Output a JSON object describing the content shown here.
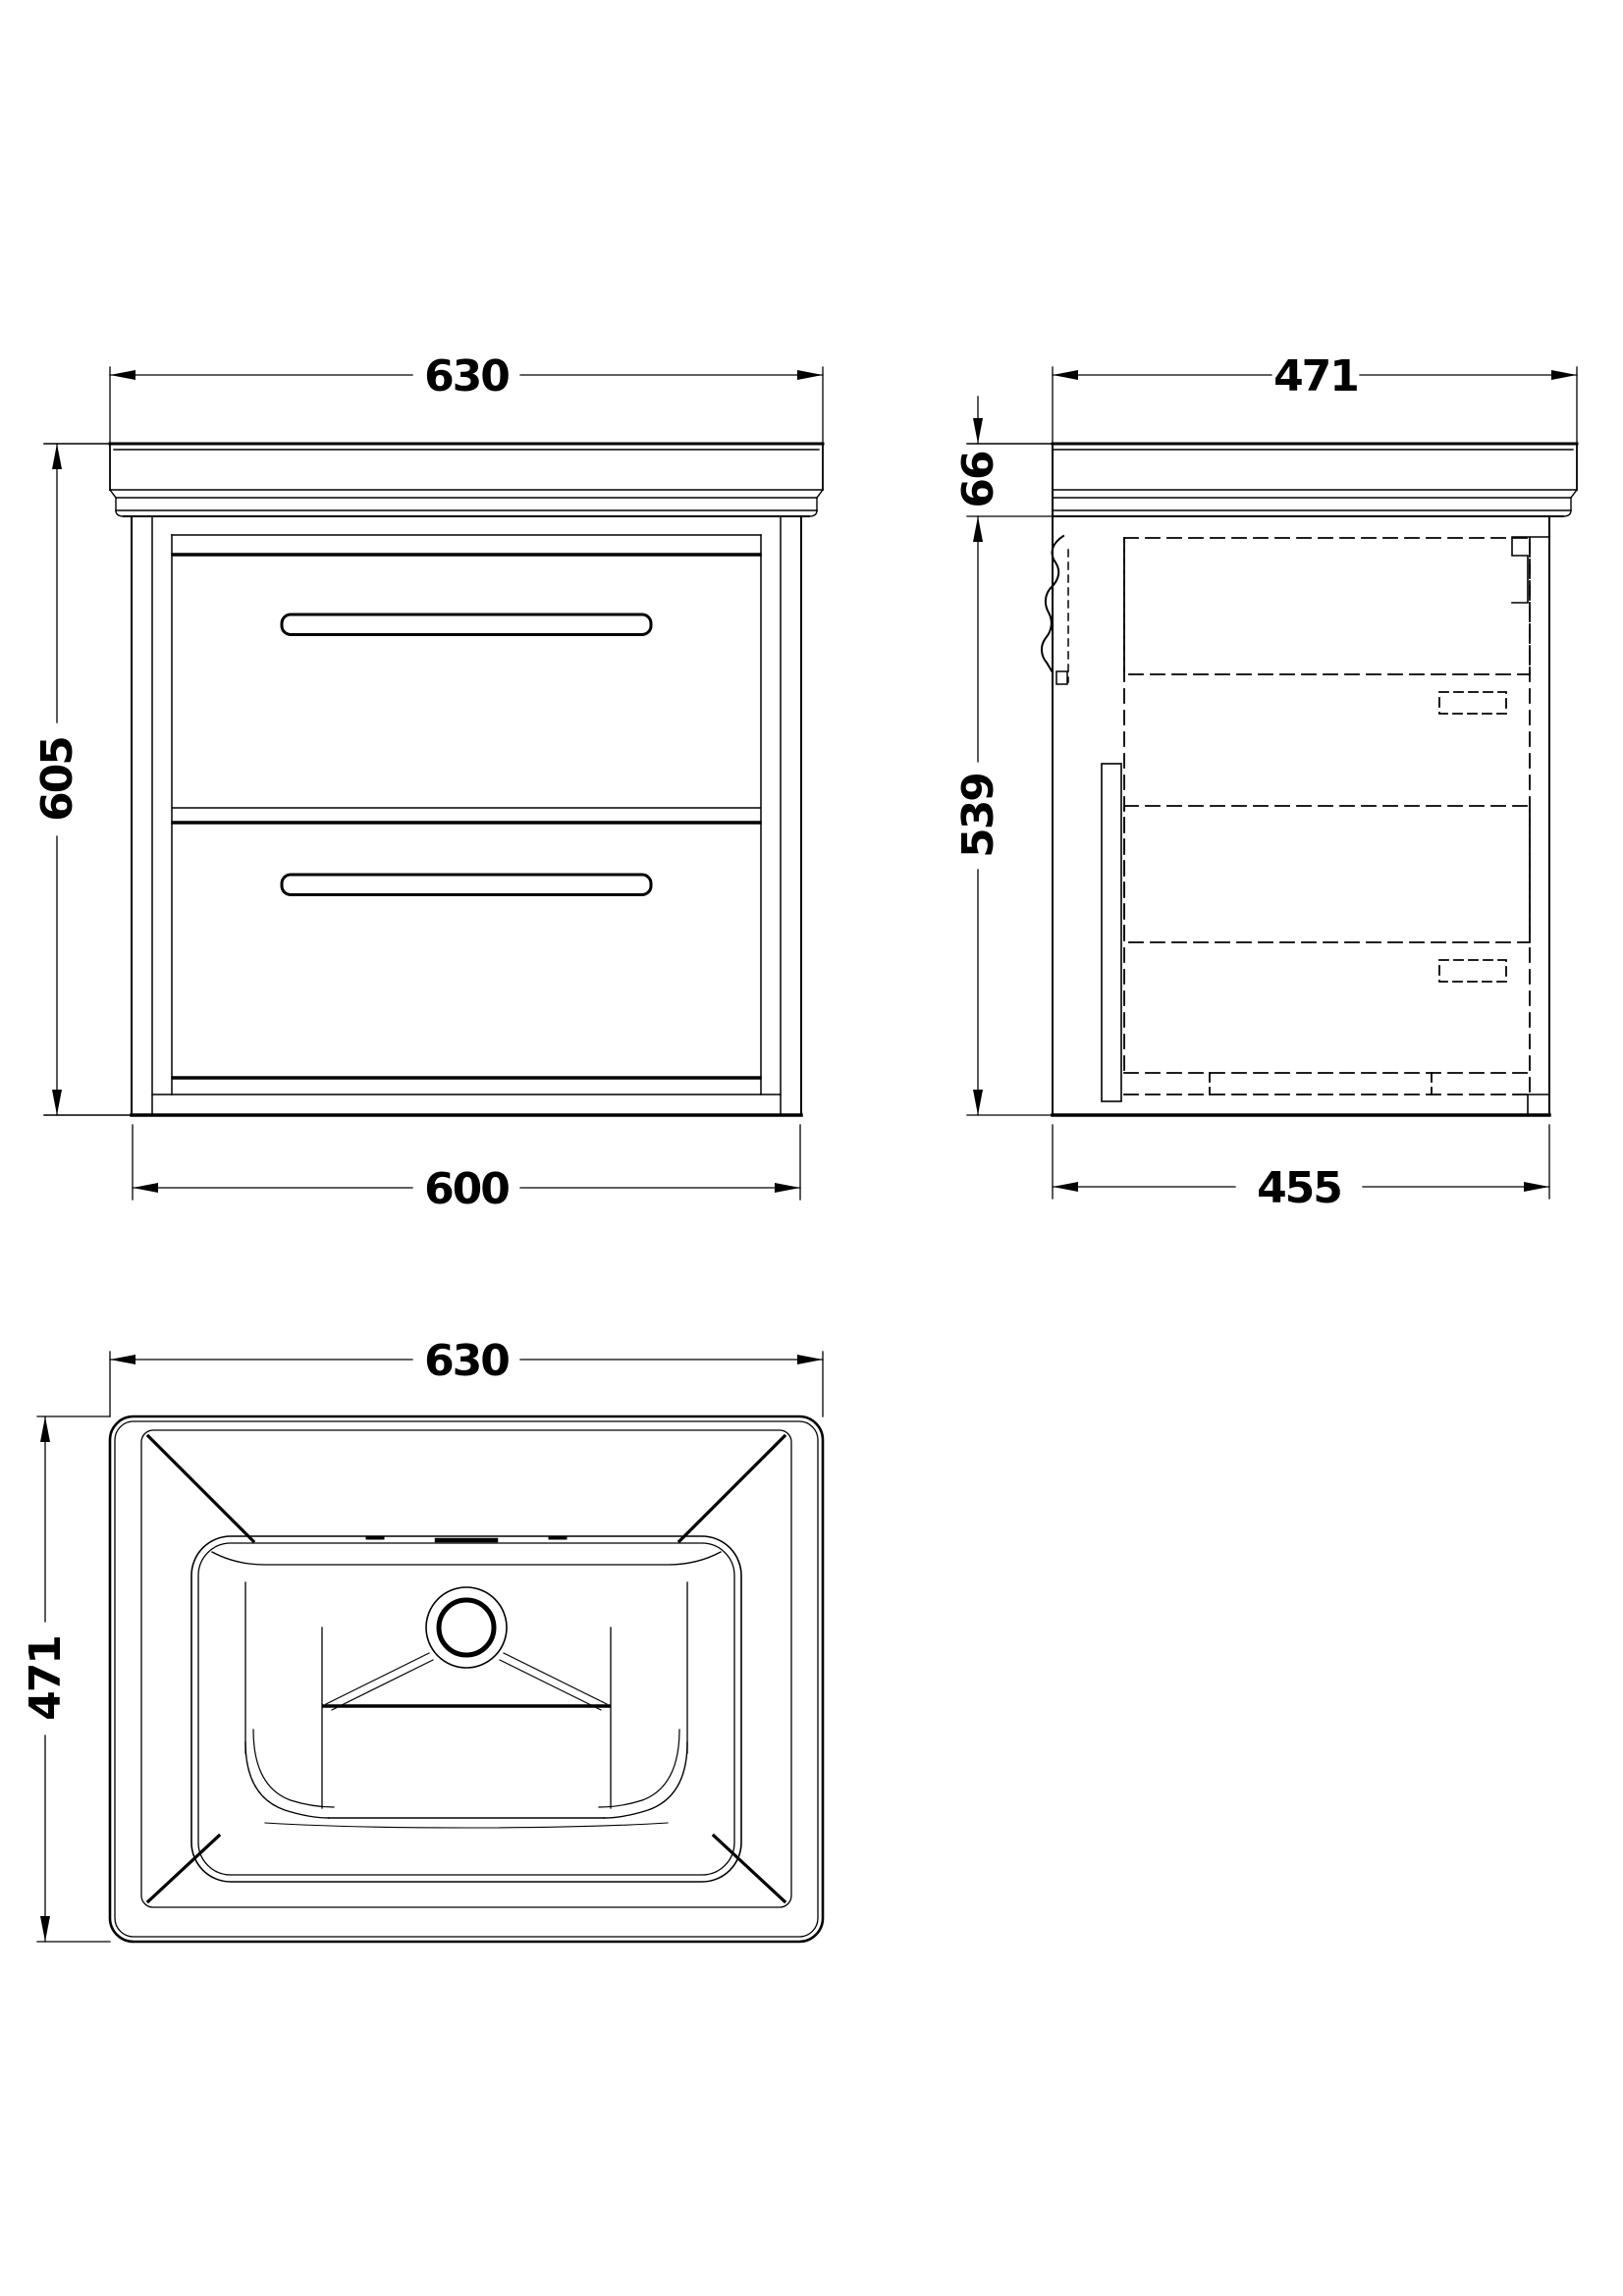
{
  "drawing": {
    "type": "technical-dimension-drawing",
    "subject": "wall-hung vanity unit with basin, three orthographic views",
    "colors": {
      "background": "#ffffff",
      "line": "#000000"
    },
    "views": {
      "front": {
        "name": "front-elevation",
        "dim_top_width": "630",
        "dim_left_height": "605",
        "dim_bottom_width": "600"
      },
      "side": {
        "name": "side-elevation",
        "dim_top_depth": "471",
        "dim_counter_height": "66",
        "dim_cabinet_height": "539",
        "dim_bottom_depth": "455"
      },
      "plan": {
        "name": "basin-plan",
        "dim_top_width": "630",
        "dim_left_depth": "471"
      }
    }
  }
}
